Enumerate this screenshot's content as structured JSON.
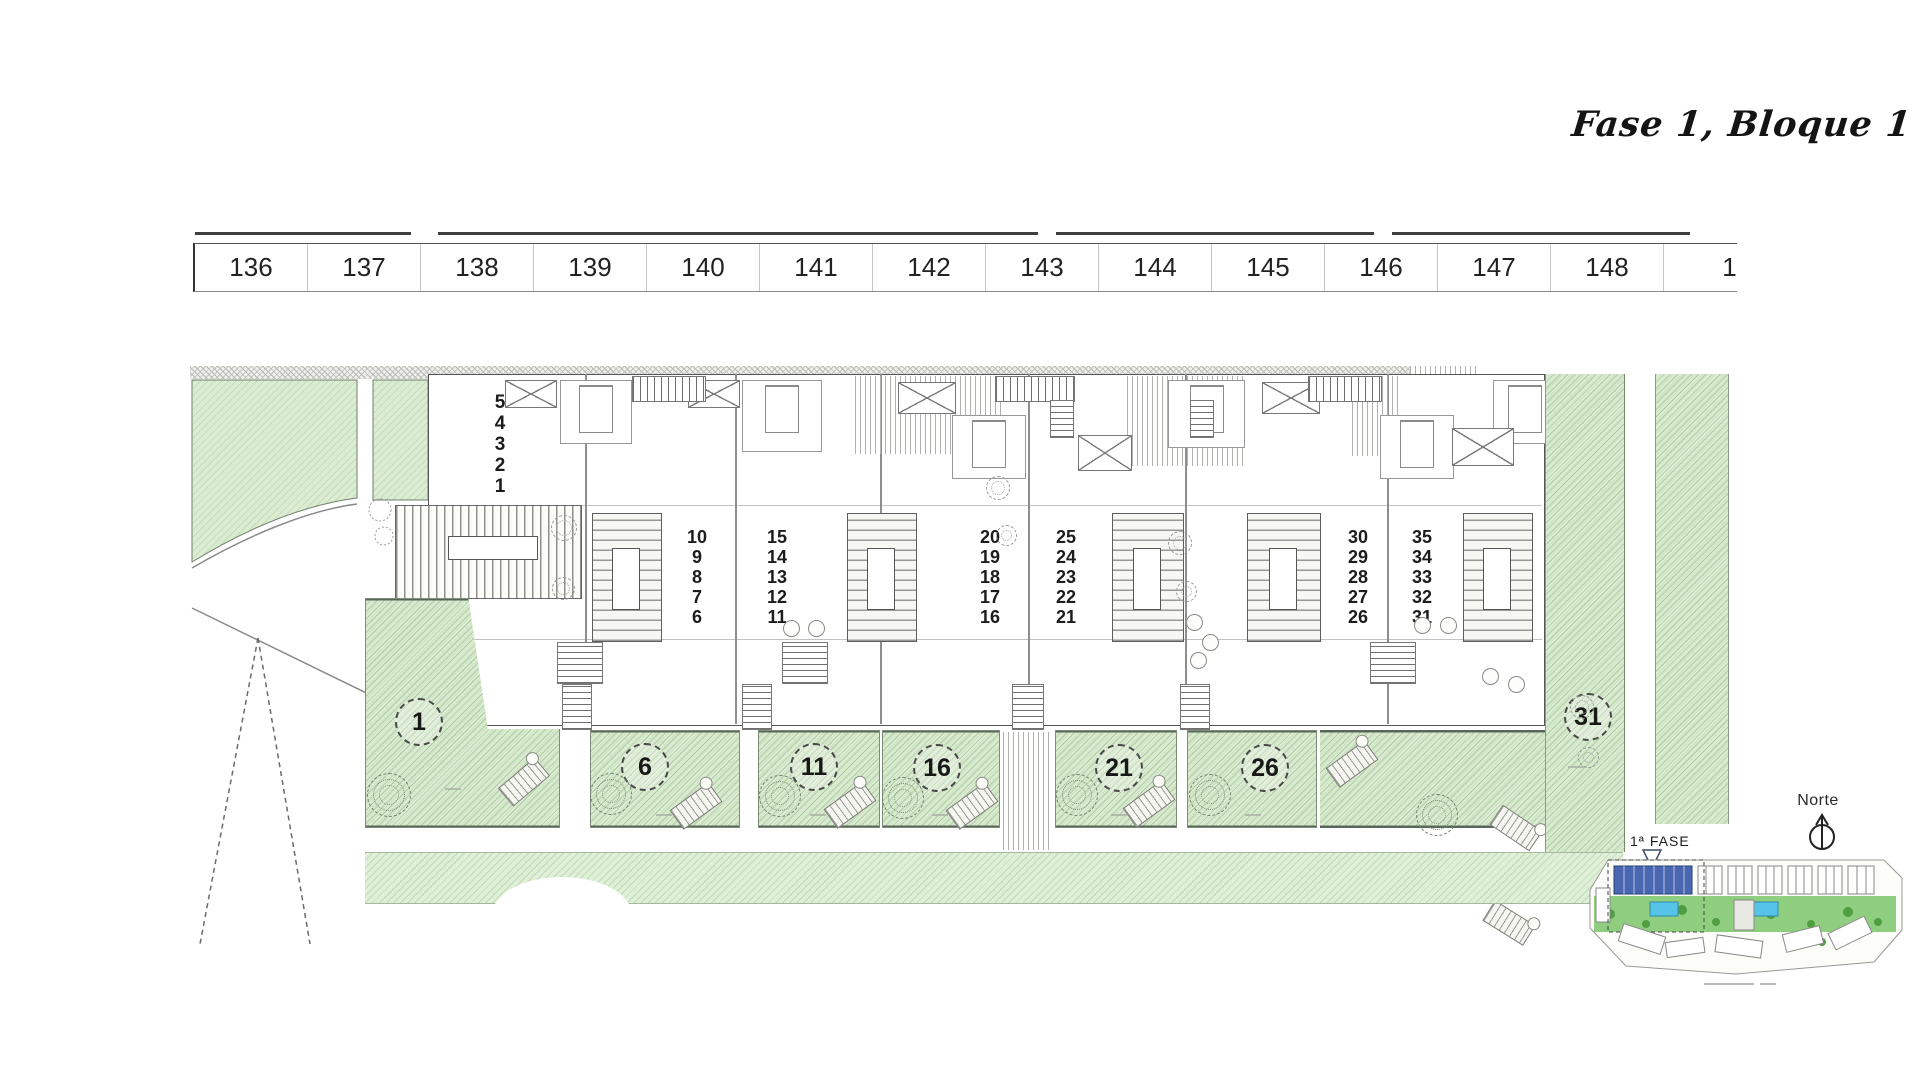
{
  "title": "Fase 1, Bloque 1",
  "ruler": {
    "cells": [
      "136",
      "137",
      "138",
      "139",
      "140",
      "141",
      "142",
      "143",
      "144",
      "145",
      "146",
      "147",
      "148",
      "149"
    ]
  },
  "unit_stacks": [
    {
      "numbers": [
        "5",
        "4",
        "3",
        "2",
        "1"
      ]
    },
    {
      "numbers": [
        "10",
        "9",
        "8",
        "7",
        "6"
      ]
    },
    {
      "numbers": [
        "15",
        "14",
        "13",
        "12",
        "11"
      ]
    },
    {
      "numbers": [
        "20",
        "19",
        "18",
        "17",
        "16"
      ]
    },
    {
      "numbers": [
        "25",
        "24",
        "23",
        "22",
        "21"
      ]
    },
    {
      "numbers": [
        "30",
        "29",
        "28",
        "27",
        "26"
      ]
    },
    {
      "numbers": [
        "35",
        "34",
        "33",
        "32",
        "31"
      ]
    }
  ],
  "garden_plots": [
    {
      "label": "1"
    },
    {
      "label": "6"
    },
    {
      "label": "11"
    },
    {
      "label": "16"
    },
    {
      "label": "21"
    },
    {
      "label": "26"
    },
    {
      "label": "31"
    }
  ],
  "compass": {
    "label": "Norte"
  },
  "key_plan": {
    "phase_label": "1ª FASE"
  },
  "colors": {
    "garden_green": "#dcecd3",
    "key_plan_green": "#7cc56a",
    "pool_blue": "#56c3e8",
    "phase_block_blue": "#4a67b2"
  }
}
